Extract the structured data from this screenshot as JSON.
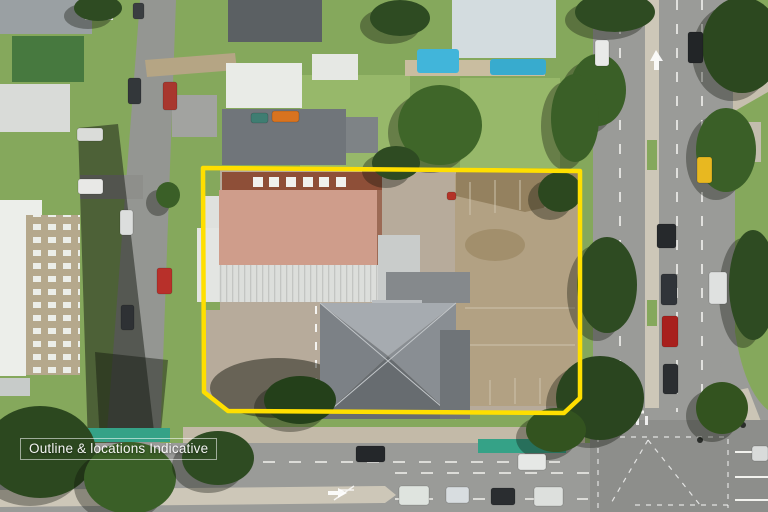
{
  "watermark": {
    "text": "Outline & locations Indicative"
  },
  "scene": {
    "description": "Aerial drone photograph of a corner development site outlined in yellow, bounded by a main arterial road on the right, a multi-lane road along the bottom and a residential street on the left, surrounded by suburban houses, apartments, a swimming pool, street trees and traffic.",
    "property": {
      "outline_points": "203,168 580,171 580,398 564,413 228,411 204,392",
      "features": [
        "terracotta-tile-roof-building-with-skylights",
        "white-ribbed-metal-roof-section",
        "large-grey-hipped-roof-building",
        "cleared-dirt-lot-with-old-slab-markings",
        "concrete-hardstand-with-painted-arrows",
        "tree-in-south-west-corner"
      ]
    },
    "roads": {
      "right": "arterial road with concrete median, two lanes each way",
      "bottom": "multi-lane road with painted median and green bike boxes",
      "left": "residential street with parked cars",
      "bottom_right": "signalised intersection with dashed guide markings"
    },
    "vehicles": [
      {
        "kind": "van-white",
        "x": 78,
        "y": 179,
        "w": 25,
        "h": 15,
        "color": "#e8e8e6"
      },
      {
        "kind": "boat",
        "x": 77,
        "y": 128,
        "w": 26,
        "h": 13,
        "color": "#dadcd9"
      },
      {
        "kind": "car-dark",
        "x": 133,
        "y": 3,
        "w": 11,
        "h": 16,
        "color": "#3a3e41"
      },
      {
        "kind": "car-dark",
        "x": 128,
        "y": 78,
        "w": 13,
        "h": 26,
        "color": "#33373a"
      },
      {
        "kind": "car-red",
        "x": 163,
        "y": 82,
        "w": 14,
        "h": 28,
        "color": "#a8372e"
      },
      {
        "kind": "car-white",
        "x": 120,
        "y": 210,
        "w": 13,
        "h": 25,
        "color": "#dcdedd"
      },
      {
        "kind": "car-red",
        "x": 157,
        "y": 268,
        "w": 15,
        "h": 26,
        "color": "#b8302a"
      },
      {
        "kind": "car-dark",
        "x": 121,
        "y": 305,
        "w": 13,
        "h": 25,
        "color": "#2e3134"
      },
      {
        "kind": "car-teal",
        "x": 251,
        "y": 113,
        "w": 17,
        "h": 10,
        "color": "#3f7d72"
      },
      {
        "kind": "car-orange",
        "x": 272,
        "y": 111,
        "w": 27,
        "h": 11,
        "color": "#d8731f"
      },
      {
        "kind": "object-red",
        "x": 447,
        "y": 192,
        "w": 9,
        "h": 8,
        "color": "#b33327"
      },
      {
        "kind": "car-white",
        "x": 595,
        "y": 40,
        "w": 14,
        "h": 26,
        "color": "#e9eae8"
      },
      {
        "kind": "car-black",
        "x": 688,
        "y": 32,
        "w": 15,
        "h": 31,
        "color": "#222527"
      },
      {
        "kind": "car-yellow",
        "x": 697,
        "y": 157,
        "w": 15,
        "h": 26,
        "color": "#e8b820"
      },
      {
        "kind": "car-black",
        "x": 657,
        "y": 224,
        "w": 19,
        "h": 24,
        "color": "#26292c"
      },
      {
        "kind": "car-dark",
        "x": 661,
        "y": 274,
        "w": 16,
        "h": 31,
        "color": "#303439"
      },
      {
        "kind": "car-red",
        "x": 662,
        "y": 316,
        "w": 16,
        "h": 31,
        "color": "#a8201d"
      },
      {
        "kind": "car-white",
        "x": 709,
        "y": 272,
        "w": 18,
        "h": 32,
        "color": "#dfe1e0"
      },
      {
        "kind": "car-dark",
        "x": 663,
        "y": 364,
        "w": 15,
        "h": 30,
        "color": "#2b2e31"
      },
      {
        "kind": "suv-dark",
        "x": 356,
        "y": 446,
        "w": 29,
        "h": 16,
        "color": "#24272a"
      },
      {
        "kind": "car-white",
        "x": 518,
        "y": 454,
        "w": 28,
        "h": 16,
        "color": "#e6e8e6"
      },
      {
        "kind": "car-white",
        "x": 399,
        "y": 486,
        "w": 30,
        "h": 19,
        "color": "#dfe4df"
      },
      {
        "kind": "car-white",
        "x": 446,
        "y": 487,
        "w": 23,
        "h": 16,
        "color": "#d8dde0"
      },
      {
        "kind": "car-dark",
        "x": 491,
        "y": 488,
        "w": 24,
        "h": 17,
        "color": "#2a2d30"
      },
      {
        "kind": "ute-white",
        "x": 534,
        "y": 487,
        "w": 29,
        "h": 19,
        "color": "#dde0dd"
      },
      {
        "kind": "car-white",
        "x": 752,
        "y": 446,
        "w": 16,
        "h": 15,
        "color": "#d9dbda"
      }
    ],
    "trees": [
      {
        "x": 615,
        "y": 12,
        "rx": 40,
        "ry": 20,
        "color": "#2e4b22"
      },
      {
        "x": 598,
        "y": 90,
        "rx": 28,
        "ry": 36,
        "color": "#3a5f27"
      },
      {
        "x": 607,
        "y": 285,
        "rx": 30,
        "ry": 48,
        "color": "#2e4b22"
      },
      {
        "x": 600,
        "y": 398,
        "rx": 44,
        "ry": 42,
        "color": "#2a451f"
      },
      {
        "x": 556,
        "y": 430,
        "rx": 30,
        "ry": 22,
        "color": "#33531f"
      },
      {
        "x": 742,
        "y": 45,
        "rx": 40,
        "ry": 48,
        "color": "#2c481f"
      },
      {
        "x": 726,
        "y": 150,
        "rx": 30,
        "ry": 42,
        "color": "#3a5f27"
      },
      {
        "x": 753,
        "y": 285,
        "rx": 24,
        "ry": 55,
        "color": "#2e4b22"
      },
      {
        "x": 722,
        "y": 408,
        "rx": 26,
        "ry": 26,
        "color": "#33531f"
      },
      {
        "x": 40,
        "y": 452,
        "rx": 56,
        "ry": 46,
        "color": "#2c481f"
      },
      {
        "x": 130,
        "y": 478,
        "rx": 46,
        "ry": 36,
        "color": "#3a5f27"
      },
      {
        "x": 218,
        "y": 458,
        "rx": 36,
        "ry": 27,
        "color": "#2e4b22"
      },
      {
        "x": 575,
        "y": 118,
        "rx": 24,
        "ry": 44,
        "color": "#3a5f27"
      },
      {
        "x": 560,
        "y": 192,
        "rx": 22,
        "ry": 20,
        "color": "#2c481f"
      },
      {
        "x": 440,
        "y": 125,
        "rx": 42,
        "ry": 40,
        "color": "#3f6629"
      },
      {
        "x": 396,
        "y": 163,
        "rx": 24,
        "ry": 17,
        "color": "#2e4b22"
      },
      {
        "x": 400,
        "y": 18,
        "rx": 30,
        "ry": 18,
        "color": "#2e4b22"
      },
      {
        "x": 300,
        "y": 400,
        "rx": 36,
        "ry": 24,
        "color": "#24401a"
      },
      {
        "x": 168,
        "y": 195,
        "rx": 12,
        "ry": 13,
        "color": "#3a5f27"
      },
      {
        "x": 98,
        "y": 8,
        "rx": 24,
        "ry": 13,
        "color": "#2e4b22"
      }
    ]
  },
  "colors": {
    "outlineYellow": "#ffdf00",
    "asphalt": "#9a9b98",
    "asphaltDark": "#8d8e8b",
    "laneWhite": "#f2f2ee",
    "medianConcrete": "#cdc7b8",
    "bikeLaneTeal": "#35a287",
    "grass": "#85a85c",
    "grassLight": "#97b86a",
    "dirt": "#b2a183",
    "dirtDark": "#94815f",
    "concrete": "#b7ab9b",
    "terracotta": "#cf9d8b",
    "terracottaRidge": "#8e4f38",
    "roofWhite": "#e9ebe7",
    "roofGrey": "#70757a",
    "roofGreyLight": "#a6abb0",
    "poolBlue": "#41b5da",
    "beige": "#b5a88c",
    "greenRoof": "#47793f"
  }
}
